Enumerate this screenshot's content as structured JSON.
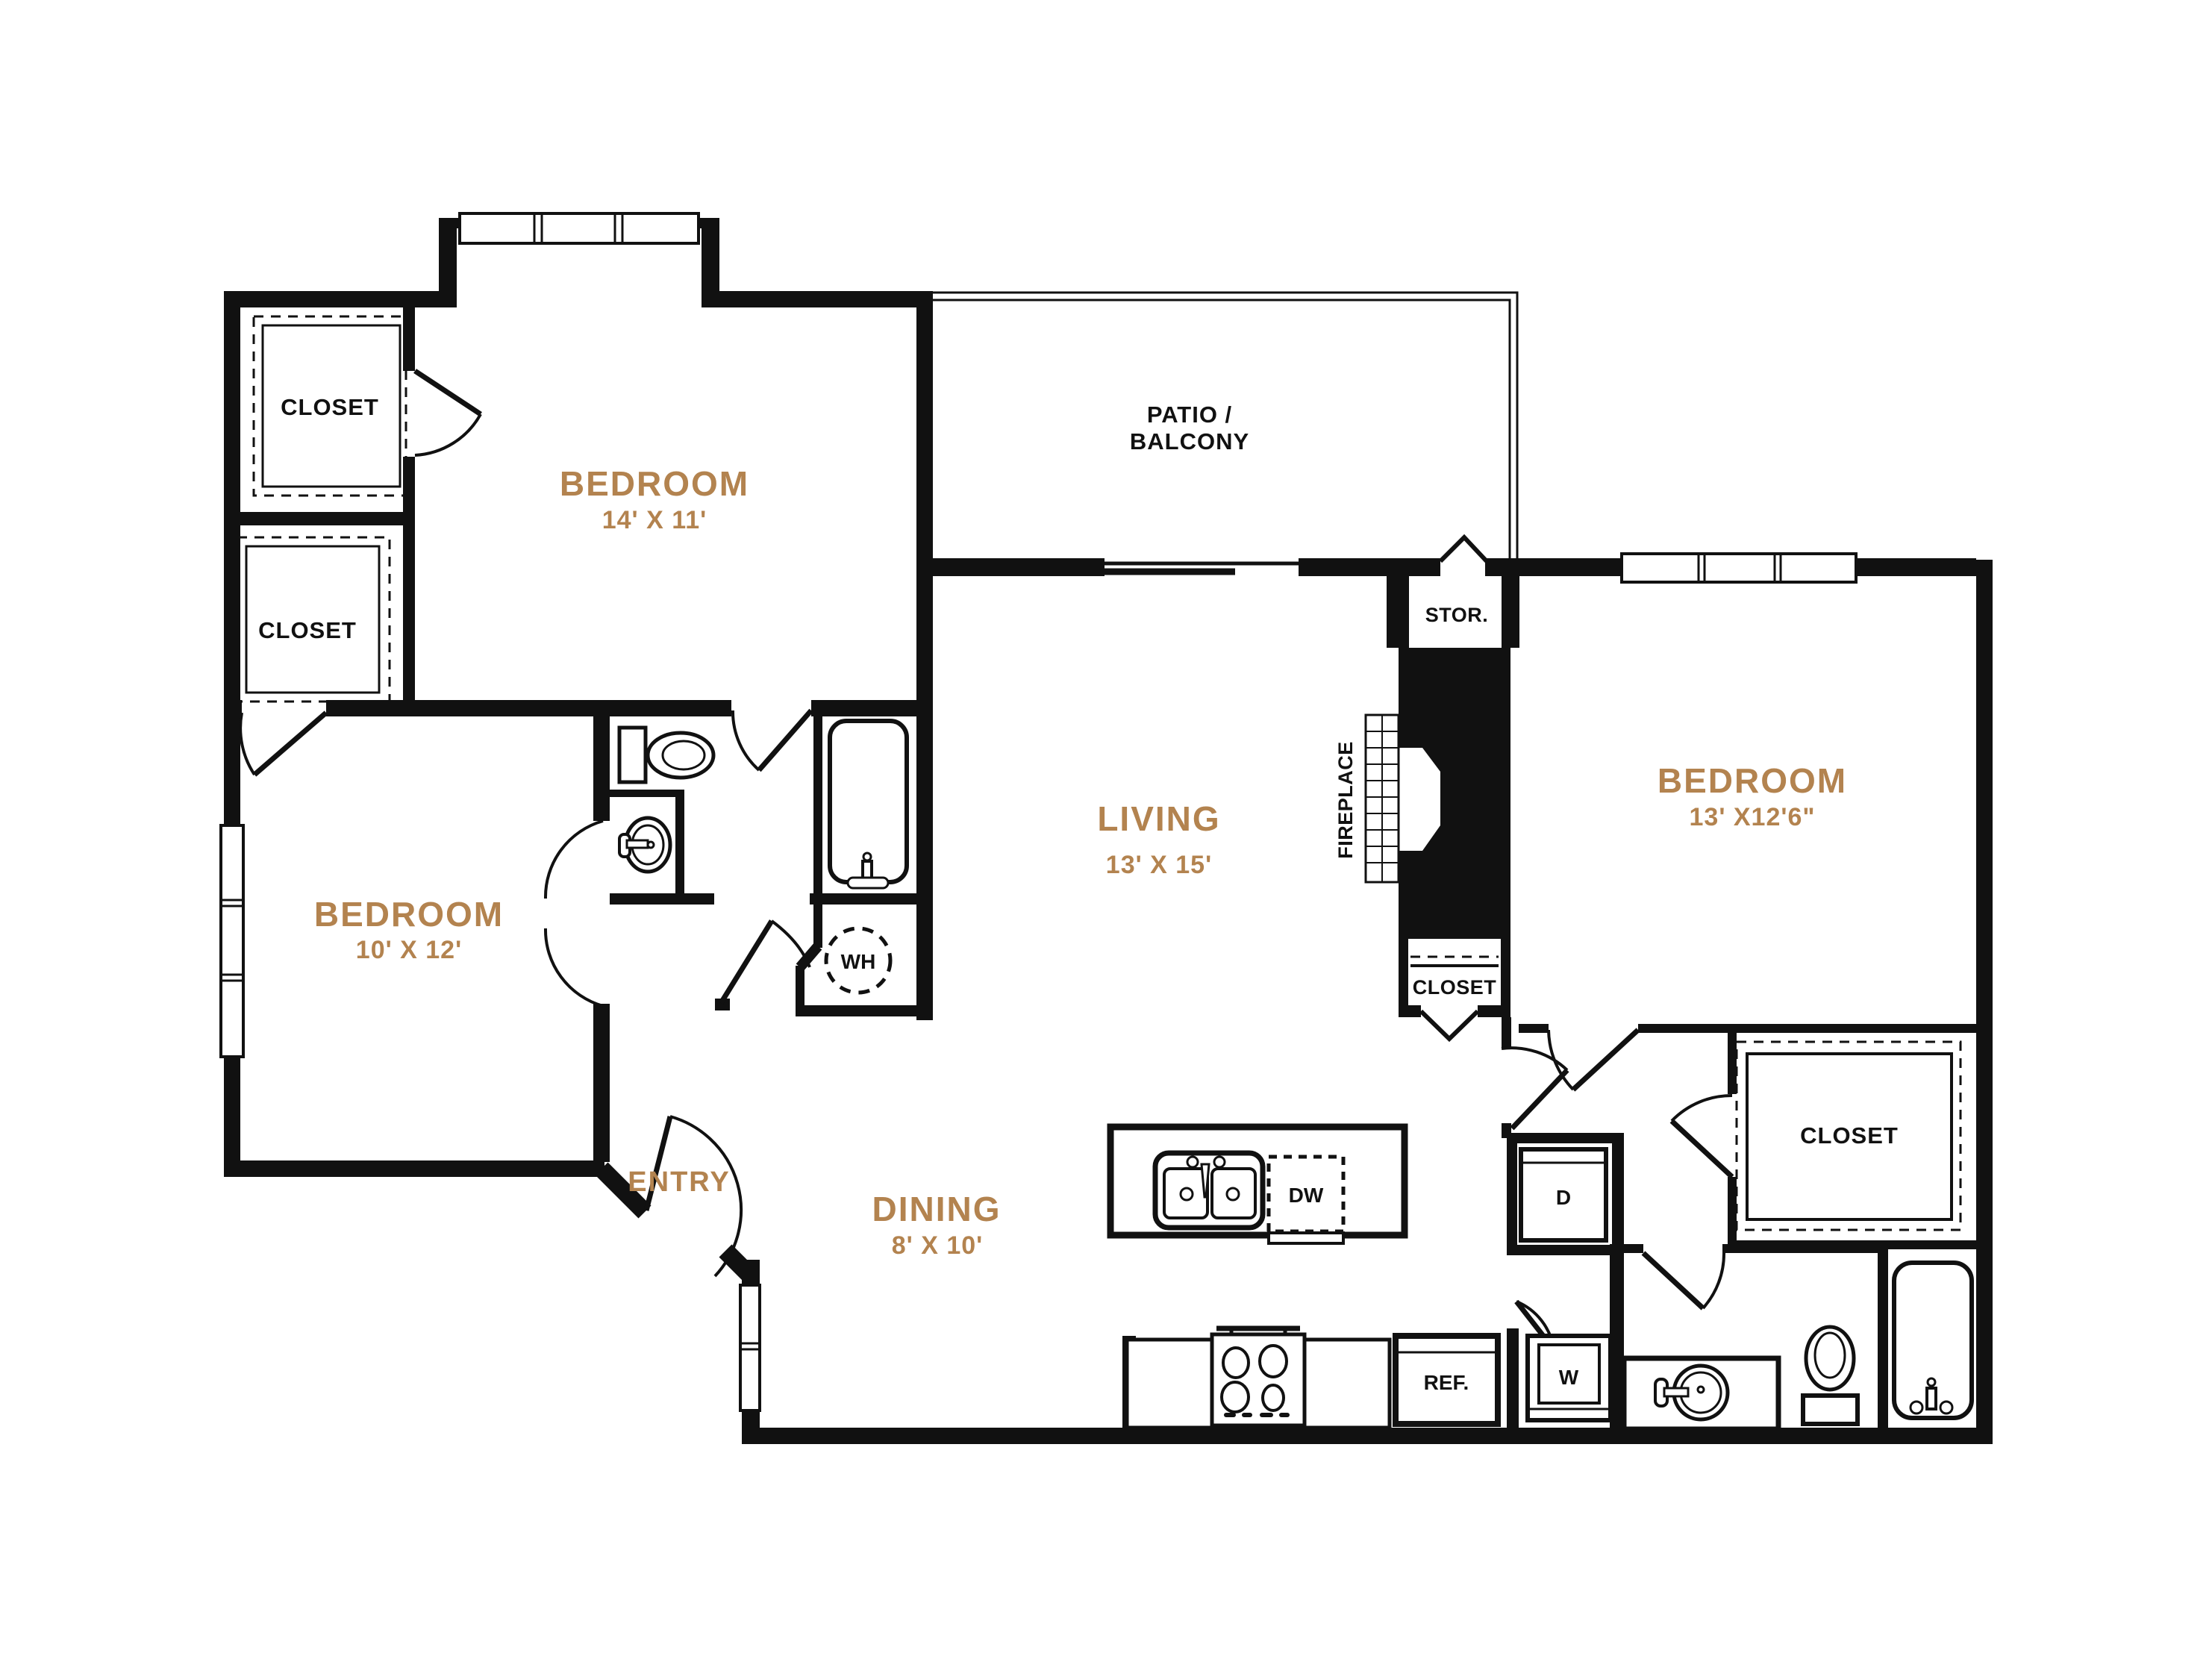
{
  "title": "Two bedroom apartment floor plan",
  "colors": {
    "walls": "#111111",
    "room_label": "#b3834f",
    "black_label": "#111111",
    "background": "#ffffff"
  },
  "labels": {
    "bedroom1_name": "BEDROOM",
    "bedroom1_dims": "14' X 11'",
    "bedroom2_name": "BEDROOM",
    "bedroom2_dims": "13' X12'6\"",
    "bedroom3_name": "BEDROOM",
    "bedroom3_dims": "10' X 12'",
    "living_name": "LIVING",
    "living_dims": "13' X 15'",
    "dining_name": "DINING",
    "dining_dims": "8' X 10'",
    "entry": "ENTRY",
    "patio_line1": "PATIO /",
    "patio_line2": "BALCONY",
    "storage": "STOR.",
    "fireplace": "FIREPLACE",
    "closet_top_left": "CLOSET",
    "closet_mid_left": "CLOSET",
    "closet_hall": "CLOSET",
    "closet_bedroom2": "CLOSET",
    "water_heater": "WH",
    "dishwasher": "DW",
    "refrigerator": "REF.",
    "washer": "W",
    "dryer": "D"
  }
}
